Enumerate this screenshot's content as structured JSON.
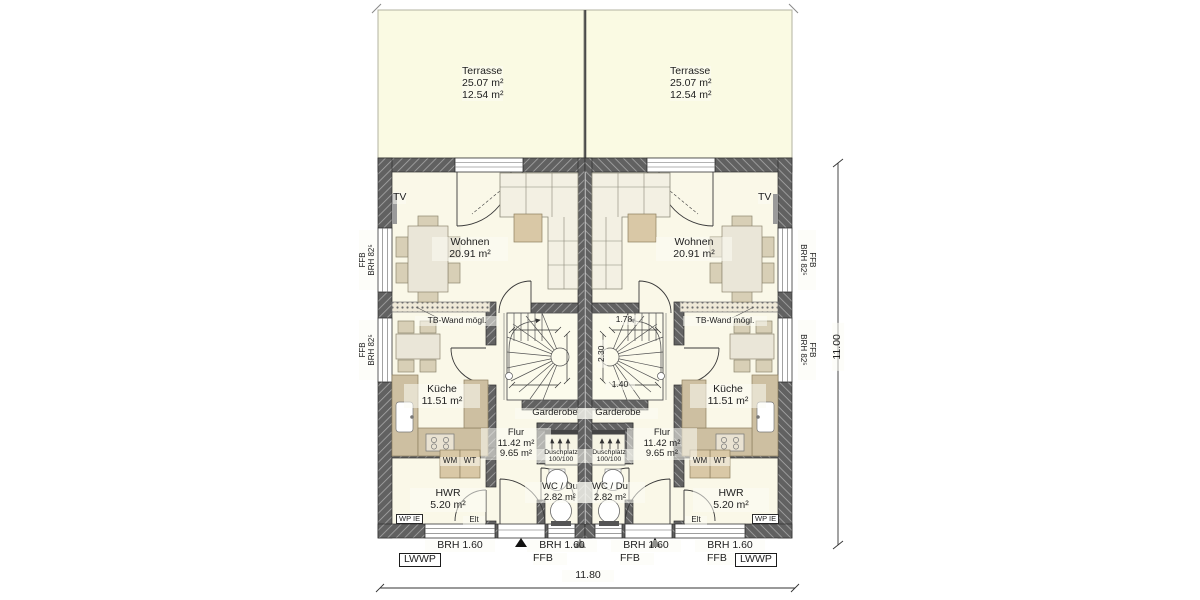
{
  "terrace": {
    "name": "Terrasse",
    "area_total": "25.07 m²",
    "area_counted": "12.54 m²"
  },
  "rooms": {
    "wohnen": {
      "name": "Wohnen",
      "area": "20.91 m²"
    },
    "kueche": {
      "name": "Küche",
      "area": "11.51 m²"
    },
    "flur": {
      "name": "Flur",
      "area_total": "11.42 m²",
      "area_counted": "9.65 m²"
    },
    "hwr": {
      "name": "HWR",
      "area": "5.20 m²"
    },
    "wc_du": {
      "name": "WC / Du",
      "area": "2.82 m²"
    },
    "garderobe": {
      "name": "Garderobe"
    }
  },
  "labels": {
    "tv": "TV",
    "tb_wand": "TB-Wand mögl.",
    "wm": "WM",
    "wt": "WT",
    "wp_unit": "WP IE",
    "elt": "Elt",
    "heat_pump": "LWWP",
    "shower": {
      "name": "Duschplatz",
      "size": "100/100"
    },
    "window_side": {
      "line1": "FFB",
      "line2": "BRH 82⁵"
    },
    "window_bottom": {
      "sill": "BRH 1.60",
      "floor": "FFB"
    }
  },
  "dimensions": {
    "total_width": "11.80",
    "total_height": "11.00",
    "stair_width": "1.78",
    "stair_depth": "2.30",
    "stair_run": "1.40"
  },
  "colors": {
    "wall": "#616161",
    "wall_hatch": "#a8a8a8",
    "terrace_fill": "#fafae3",
    "floor_fill": "#faf8e8",
    "furniture": "#d8cfb6",
    "table": "#eae6d8",
    "counter": "#cdbfa1",
    "coffee_table": "#d9c8a6",
    "line": "#333333"
  }
}
